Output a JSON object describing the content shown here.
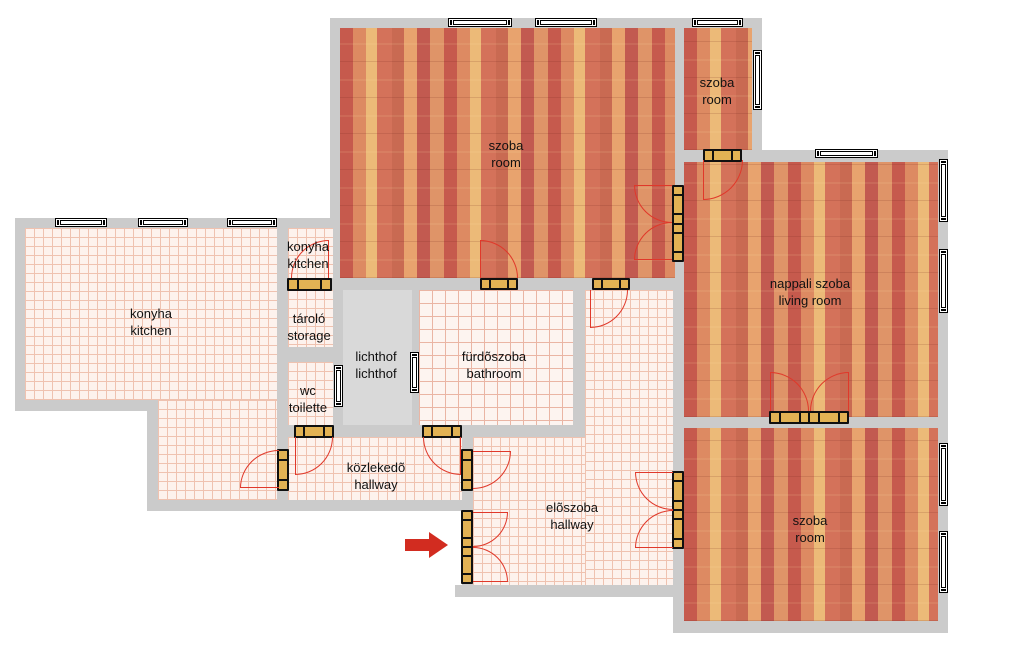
{
  "document": {
    "type": "apartment floor plan"
  },
  "rooms": {
    "szoba_top": {
      "hu": "szoba",
      "en": "room"
    },
    "szoba_small": {
      "hu": "szoba",
      "en": "room"
    },
    "nappali": {
      "hu": "nappali szoba",
      "en": "living room"
    },
    "szoba_bottom": {
      "hu": "szoba",
      "en": "room"
    },
    "konyha_large": {
      "hu": "konyha",
      "en": "kitchen"
    },
    "konyha_small": {
      "hu": "konyha",
      "en": "kitchen"
    },
    "tarolo": {
      "hu": "tároló",
      "en": "storage"
    },
    "lichthof": {
      "hu": "lichthof",
      "en": "lichthof"
    },
    "wc": {
      "hu": "wc",
      "en": "toilette"
    },
    "furdoszoba": {
      "hu": "fürdõszoba",
      "en": "bathroom"
    },
    "kozlekedo": {
      "hu": "közlekedõ",
      "en": "hallway"
    },
    "eloszoba": {
      "hu": "elõszoba",
      "en": "hallway"
    }
  },
  "colors": {
    "wall": "#cbcbcb",
    "lichthof_fill": "#d9d9d9",
    "tile_floor": "#fdf2ed",
    "tile_grid": "#efc2b0",
    "parquet_base": "#dc8a64",
    "door_sill": "#e2b254",
    "door_arc": "#e0382a",
    "entrance_arrow": "#d22c20",
    "window_fill": "#ffffff",
    "outline": "#000000"
  }
}
